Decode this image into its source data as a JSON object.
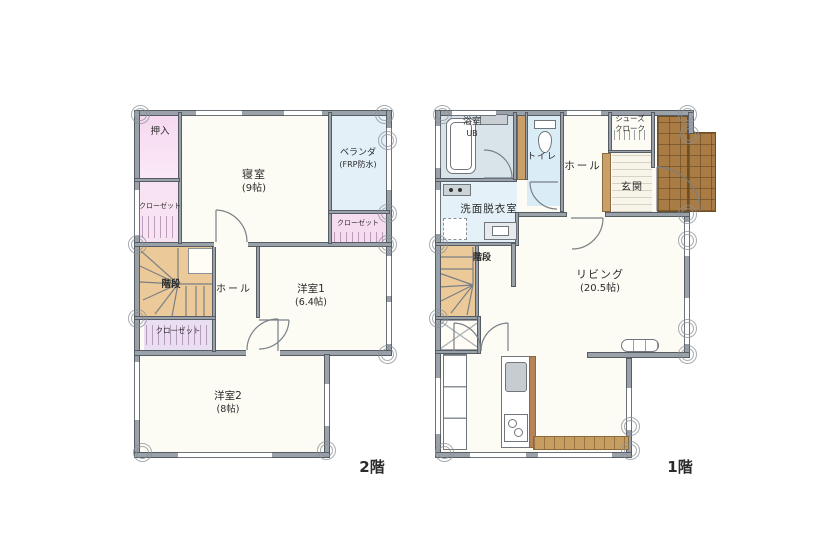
{
  "document": {
    "type": "floor-plan",
    "background": "#ffffff"
  },
  "palette": {
    "wall": "#9ba1a8",
    "wall_edge": "#565c63",
    "room_fill": "#fcfbf4",
    "closet_pink": "#f6dcef",
    "closet_lavender": "#eadef2",
    "water_blue": "#daedf7",
    "bath_gray_blue": "#d9e4ea",
    "laundry_blue": "#e4f1f9",
    "veranda_blue": "#e3f0f8",
    "stairs_tan": "#ecc998",
    "porch_brown": "#a87c44",
    "deck_brown": "#c79e62",
    "label_ink": "#2b2b2b"
  },
  "floor2": {
    "floor_label": "2階",
    "rooms": {
      "oshiire": "押入",
      "closet_left": "クローゼット",
      "bedroom_name": "寝室",
      "bedroom_size": "(9帖)",
      "veranda_name": "ベランダ",
      "veranda_note": "(FRP防水)",
      "closet_right": "クローゼット",
      "stairs": "階段",
      "hall": "ホール",
      "room1_name": "洋室1",
      "room1_size": "(6.4帖)",
      "closet_bottom": "クローゼット",
      "room2_name": "洋室2",
      "room2_size": "(8帖)"
    }
  },
  "floor1": {
    "floor_label": "1階",
    "rooms": {
      "bath_name": "浴室",
      "bath_note": "UB",
      "toilet": "トイレ",
      "laundry": "洗面脱衣室",
      "hall": "ホール",
      "shoes_line1": "シューズ",
      "shoes_line2": "クローク",
      "entrance": "玄関",
      "stairs": "階段",
      "living_name": "リビング",
      "living_size": "(20.5帖)"
    }
  }
}
